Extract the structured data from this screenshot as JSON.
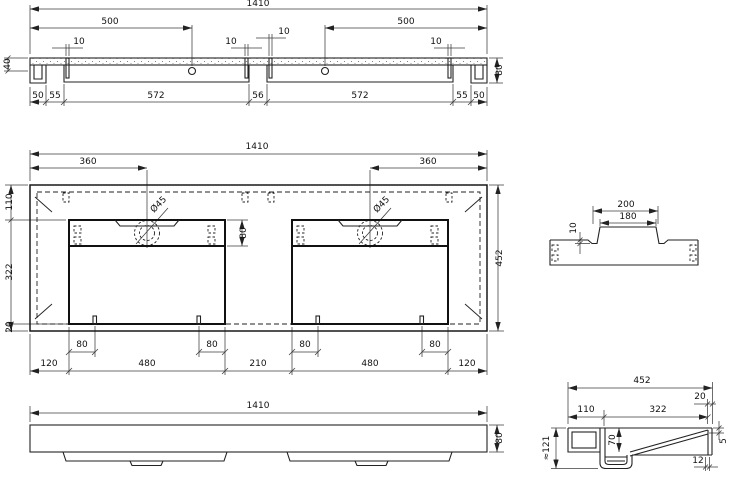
{
  "views": {
    "top": {
      "overall": "1410",
      "hole_left": "500",
      "hole_right": "500",
      "slots": [
        "10",
        "10",
        "10",
        "10"
      ],
      "height_left": "40",
      "height_right": "80",
      "chain": [
        "50",
        "55",
        "572",
        "56",
        "572",
        "55",
        "50"
      ]
    },
    "plan": {
      "overall": "1410",
      "hole_left": "360",
      "hole_right": "360",
      "dia_left": "Ø45",
      "dia_right": "Ø45",
      "strip_height": "80",
      "v_chain": [
        "110",
        "322",
        "20"
      ],
      "depth": "452",
      "slot_offsets": [
        "80",
        "80",
        "80",
        "80"
      ],
      "chain": [
        "120",
        "480",
        "210",
        "480",
        "120"
      ]
    },
    "deck": {
      "outer": "200",
      "inner": "180",
      "step": "10"
    },
    "front": {
      "overall": "1410",
      "height": "80"
    },
    "side": {
      "depth": "452",
      "front_edge": "20",
      "back": "110",
      "span": "322",
      "total_height": "≈121",
      "basin_depth": "70",
      "lip": "5",
      "wall": "12"
    }
  }
}
